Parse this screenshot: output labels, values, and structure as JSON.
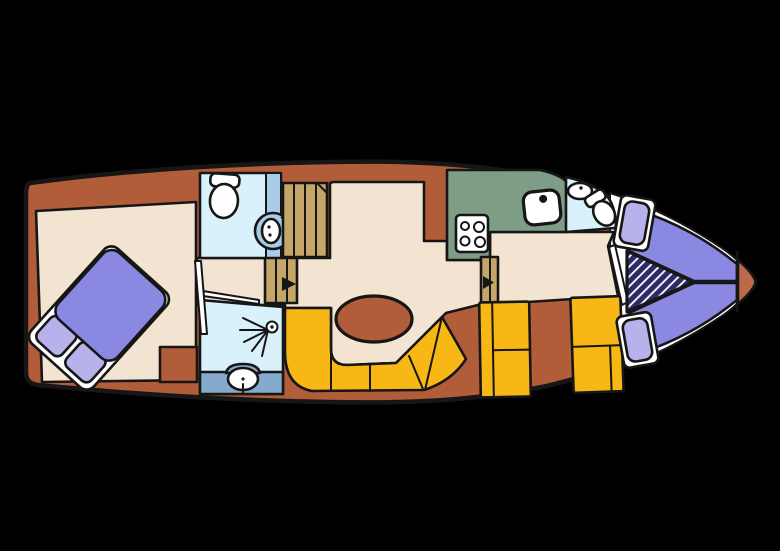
{
  "title": "boat-floor-plan",
  "colors": {
    "background": "#000000",
    "outline": "#161616",
    "hull": "#b25d3a",
    "bow_tip": "#bb6a47",
    "floor": "#f2e4d0",
    "bathroom": "#d9f1fa",
    "door_strip": "#a8cbe7",
    "shower_counter": "#85aacd",
    "stairs": "#c4a768",
    "galley_counter": "#7d9d86",
    "seat": "#f7b714",
    "berth": "#8b88e1",
    "pillow": "#b7b2ec",
    "infill": "#2d2b67",
    "white": "#ffffff"
  },
  "plan": {
    "rooms": [
      "aft-cabin",
      "aft-bathroom",
      "companionway-stairs",
      "shower-room",
      "salon",
      "galley",
      "bow-bathroom",
      "bow-cabin"
    ],
    "fixtures": [
      "double-bed",
      "pillows",
      "toilet",
      "washbasin",
      "shower-head",
      "dinette-table",
      "curved-bench",
      "seat-blocks",
      "stove",
      "sink",
      "v-berth",
      "infill-cushion",
      "bow-tip",
      "door-arrows"
    ]
  }
}
